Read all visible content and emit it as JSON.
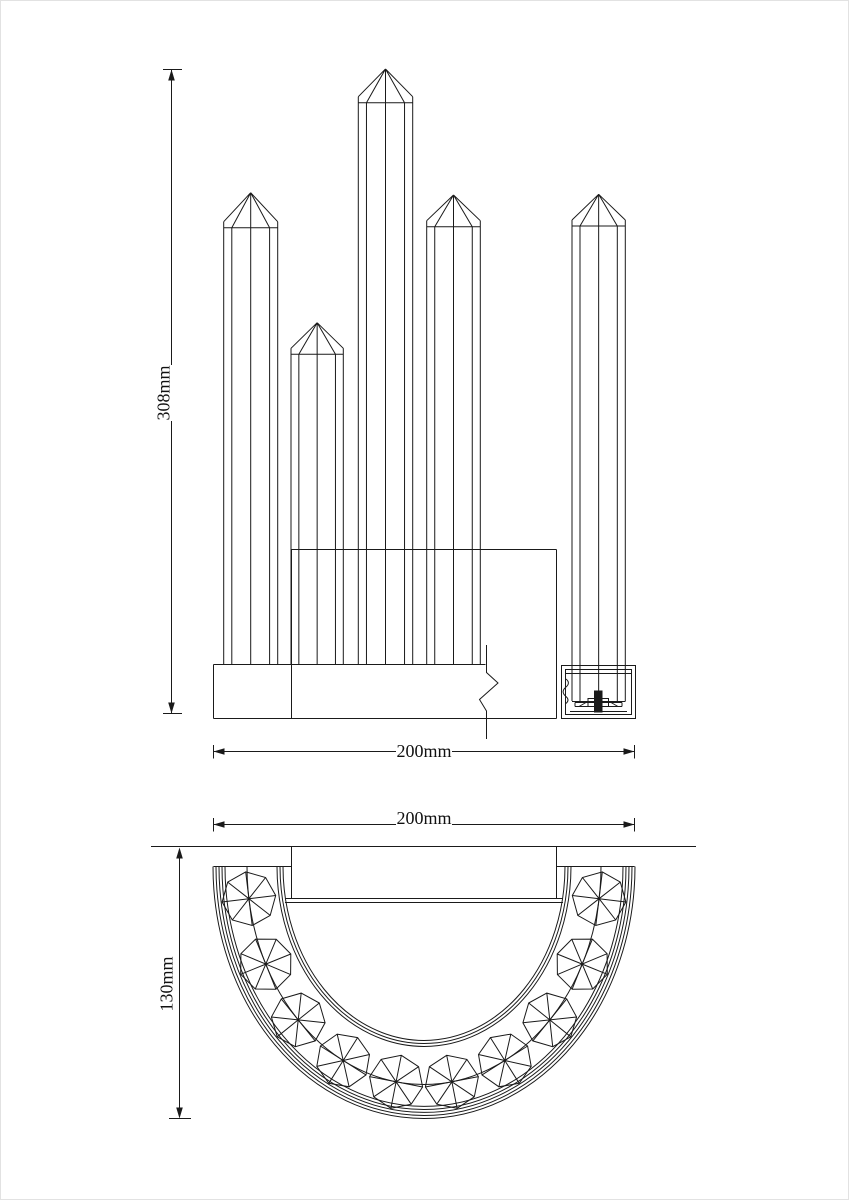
{
  "front_view": {
    "view_name": "front-elevation",
    "height_dim": "308mm",
    "width_dim": "200mm",
    "rod_count": 5
  },
  "top_view": {
    "view_name": "top-plan",
    "width_dim": "200mm",
    "depth_dim": "130mm",
    "crystal_count": 10
  },
  "style": {
    "line_color": "#1a1a1a",
    "background": "#ffffff"
  }
}
